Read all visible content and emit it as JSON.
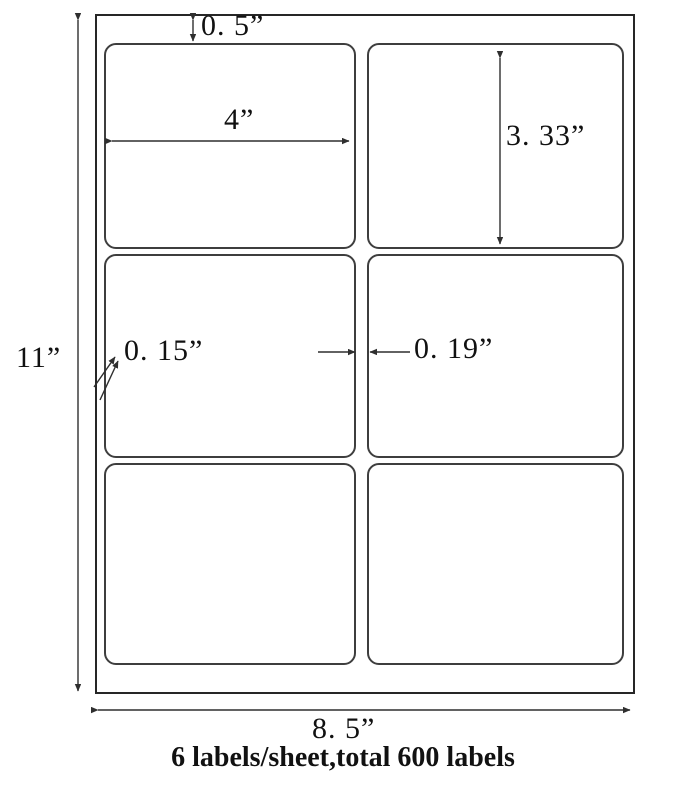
{
  "page": {
    "caption": "6 labels/sheet,total 600 labels"
  },
  "sheet": {
    "grid": {
      "rows": 3,
      "cols": 2,
      "label_count": 6
    },
    "annotations": {
      "top_margin": "0. 5”",
      "label_width": "4”",
      "label_height": "3. 33”",
      "side_margin": "0. 15”",
      "column_gap": "0. 19”",
      "sheet_height": "11”",
      "sheet_width": "8. 5”"
    },
    "colors": {
      "line": "#2f2f2f",
      "text": "#111111",
      "background": "#ffffff"
    }
  }
}
